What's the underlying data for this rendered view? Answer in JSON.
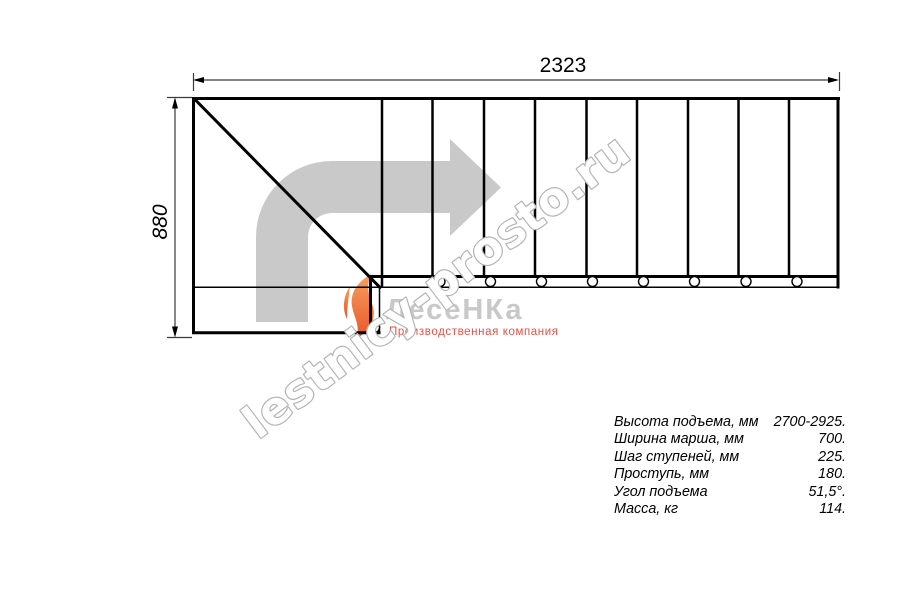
{
  "drawing": {
    "width_dimension": "2323",
    "height_dimension": "880",
    "line_color": "#000000",
    "arrow_fill": "#c9c9c9"
  },
  "logo": {
    "brand": "ЛесеНКа",
    "tagline": "Производственная компания",
    "brand_color": "#c8c8c8",
    "tagline_color": "#e2524a",
    "flame_color_top": "#f5a15f",
    "flame_color_bottom": "#e9562a"
  },
  "watermark": {
    "text": "lestnicy-prosto.ru",
    "outline_color": "#b4b4b4",
    "fill_color": "#ffffff"
  },
  "specs": {
    "rows": [
      {
        "label": "Высота подъема, мм",
        "value": "2700-2925."
      },
      {
        "label": "Ширина марша, мм",
        "value": "700."
      },
      {
        "label": "Шаг ступеней, мм",
        "value": "225."
      },
      {
        "label": "Проступь, мм",
        "value": "180."
      },
      {
        "label": "Угол подъема",
        "value": "51,5°."
      },
      {
        "label": "Масса, кг",
        "value": "114."
      }
    ]
  }
}
